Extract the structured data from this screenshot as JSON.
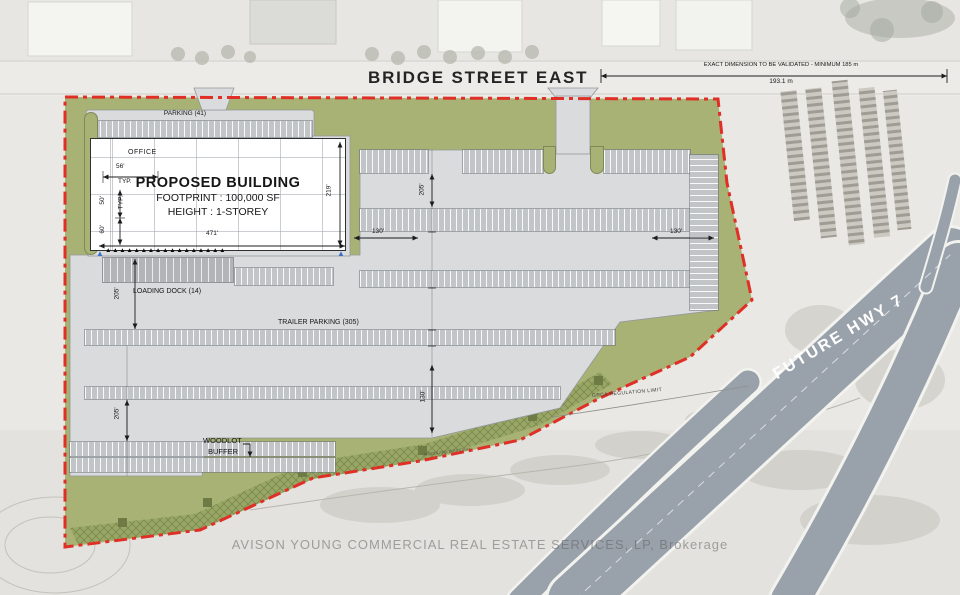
{
  "header": {
    "street_name": "BRIDGE STREET EAST",
    "dim_note": "EXACT DIMENSION TO BE VALIDATED - MINIMUM 185 m",
    "dim_value": "193.1 m"
  },
  "building": {
    "office": "OFFICE",
    "title": "PROPOSED BUILDING",
    "footprint": "FOOTPRINT : 100,000 SF",
    "height": "HEIGHT : 1-STOREY"
  },
  "labels": {
    "parking": "PARKING (41)",
    "loading_dock": "LOADING DOCK (14)",
    "trailer_parking": "TRAILER PARKING (305)",
    "woodlot_1": "WOODLOT",
    "woodlot_2": "BUFFER",
    "grca": "GRCA REGULATION LIMIT",
    "woodland": "WOODLAND BOUNDARY",
    "future_hwy": "FUTURE HWY 7"
  },
  "dims": {
    "w56": "56'",
    "typ": "TYP.",
    "d50": "50'",
    "d60": "60'",
    "len471": "471'",
    "dep219": "219'",
    "l205a": "205'",
    "l205b": "205'",
    "m205": "205'",
    "m130": "130'",
    "g130w": "130'",
    "g130e": "130'"
  },
  "decor": {
    "dock_markers": "▲▲▲▲▲▲▲▲▲▲▲▲▲▲▲▲▲",
    "ramp_marker": "▲"
  },
  "watermark": "AVISON YOUNG COMMERCIAL REAL ESTATE SERVICES, LP, Brokerage",
  "colors": {
    "site_green": "#a7b274",
    "pavement": "#d9dbdd",
    "boundary_red": "#df2f26",
    "highway": "#99a1ab"
  }
}
